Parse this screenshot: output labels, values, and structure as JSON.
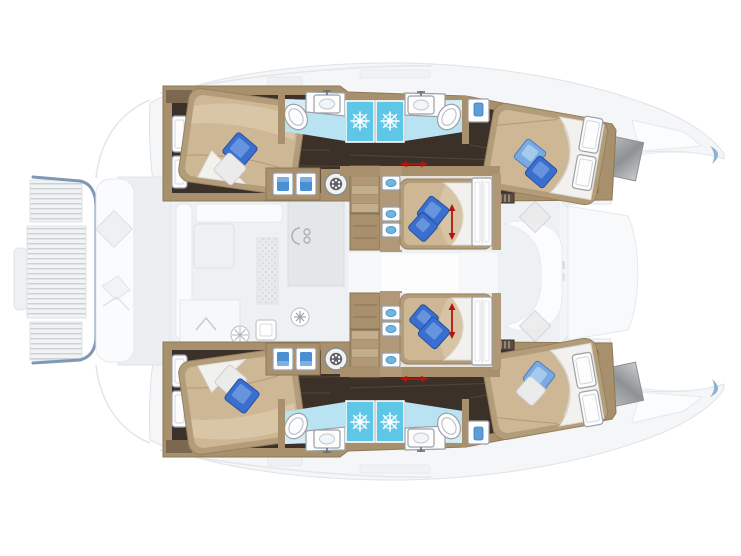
{
  "page": {
    "background_color": "#ffffff"
  },
  "colors": {
    "bg": "#ffffff",
    "deckFill": "#f4f6f7",
    "deckLine": "#dfe3e7",
    "deckFurniture": "#eceff1",
    "platformOutline": "#7f98b4",
    "slatLine": "#ccd1d6",
    "wood": "#a8906d",
    "woodLight": "#c3ae8b",
    "woodDark": "#7c6750",
    "floor": "#3c3128",
    "floorStreak": "#6b5948",
    "bedFrame": "#b29c7a",
    "bed": "#cdb795",
    "bedHighlight": "#dcc9ab",
    "linen": "#f2f1ee",
    "linenShadow": "#d8d5cf",
    "pillowBlue": "#3a6fd0",
    "pillowBlueLight": "#7aaae4",
    "pillowWhite": "#ebebeb",
    "bathFloor": "#b9e3f2",
    "bathFloorLight": "#d2edf8",
    "shower": "#5ec7e8",
    "fixtureWhite": "#fdfdfe",
    "fixtureLine": "#9aa0a6",
    "applianceBlue": "#4a8fd4",
    "hatchGray": "#a7a9ab",
    "bowTipBlue": "#8fb2d4",
    "arrowRed": "#b51212"
  },
  "plan": {
    "vessel": "catamaran",
    "view": "top-down interior deck plan, bows to the right",
    "symmetry": "upper and lower hulls are mirrored",
    "areas": {
      "upper_hull": {
        "cabins": [
          {
            "name": "aft double cabin",
            "bed": "double",
            "pillows": [
              "blue",
              "white"
            ],
            "hull_windows": 2
          },
          {
            "name": "forward double cabin",
            "bed": "double",
            "pillows": [
              "light blue",
              "blue"
            ],
            "wardrobe_doors": 2
          }
        ],
        "bathrooms": [
          {
            "name": "aft head",
            "fixtures": [
              "toilet",
              "washbasin",
              "shower"
            ]
          },
          {
            "name": "forward head",
            "fixtures": [
              "washbasin",
              "toilet",
              "shower"
            ]
          }
        ],
        "corridor": [
          "storage cabinets",
          "two appliances",
          "washing machine",
          "staircase"
        ]
      },
      "lower_hull": {
        "cabins": [
          {
            "name": "aft double cabin",
            "bed": "double",
            "pillows": [
              "white",
              "blue"
            ],
            "hull_windows": 2
          },
          {
            "name": "forward double cabin",
            "bed": "double",
            "pillows": [
              "blue",
              "white"
            ],
            "wardrobe_doors": 2
          }
        ],
        "bathrooms": [
          {
            "name": "aft head",
            "fixtures": [
              "toilet",
              "washbasin",
              "shower"
            ]
          },
          {
            "name": "forward head",
            "fixtures": [
              "washbasin",
              "toilet",
              "shower"
            ]
          }
        ],
        "corridor": [
          "storage cabinets",
          "two appliances",
          "washing machine",
          "staircase"
        ]
      },
      "nacelle_cabins": [
        {
          "name": "upper centre double cabin",
          "bed": "double",
          "pillows": [
            "blue",
            "blue"
          ],
          "washbasin_units": 3,
          "dimension_arrow": "red"
        },
        {
          "name": "lower centre double cabin",
          "bed": "double",
          "pillows": [
            "blue",
            "blue"
          ],
          "washbasin_units": 3,
          "dimension_arrow": "red"
        }
      ],
      "main_deck_faded": {
        "saloon": [
          "sofa",
          "table",
          "bench seat"
        ],
        "galley": [
          "counter",
          "cooktop",
          "burner",
          "sink",
          "hatch ring"
        ],
        "aft_cockpit": [
          "bench",
          "two tables"
        ],
        "aft_platform": {
          "teak_slat_sections": 3,
          "outline": "blue-gray"
        },
        "foredeck": [
          "c-shaped sofa",
          "two cushions",
          "deck hatches"
        ],
        "bows": 2
      }
    },
    "fixture_counts": {
      "double_beds": 6,
      "toilets": 4,
      "showers": 4,
      "bathroom_washbasins": 4,
      "staircases": 2,
      "washing_machines": 2
    },
    "annotations": {
      "dimension_arrows": "red double-headed arrows marking centre-cabin bed length"
    }
  }
}
